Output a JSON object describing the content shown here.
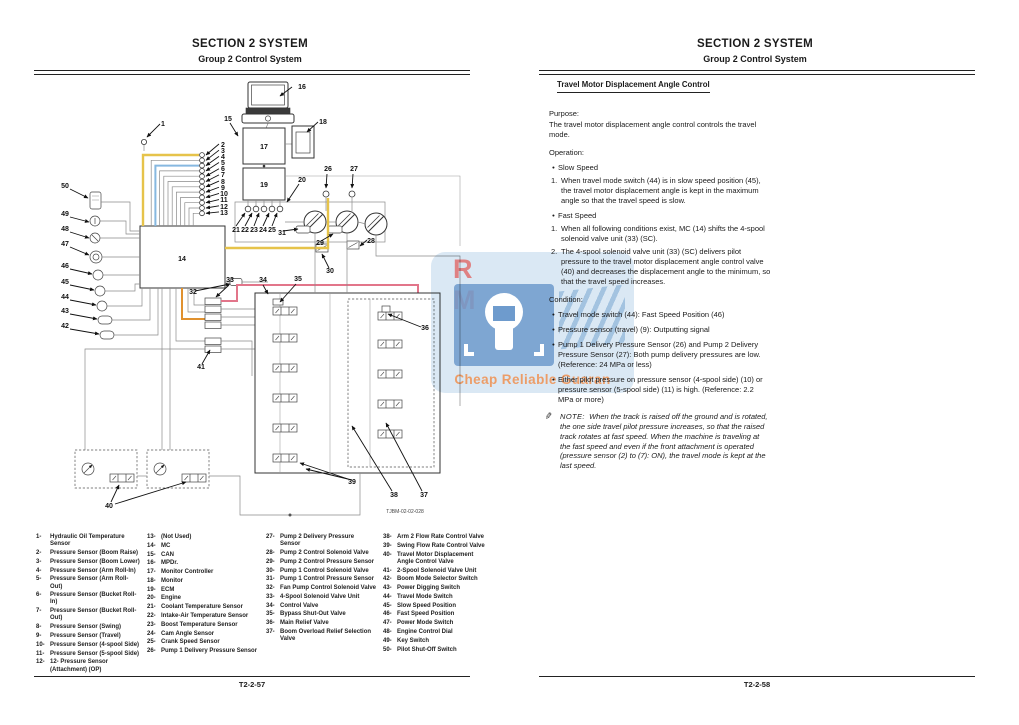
{
  "header": {
    "line1": "SECTION 2 SYSTEM",
    "line2": "Group 2 Control System"
  },
  "footer": {
    "left_page_number": "T2-2-57",
    "right_page_number": "T2-2-58"
  },
  "colors": {
    "can_line": "#e6c34a",
    "signal_line_blue": "#86b8e0",
    "pilot_line_pink": "#e2758a",
    "power_line_orange": "#e0912f",
    "watermark_blue": "#6e9bcd",
    "watermark_text_orange": "#ee965a",
    "watermark_rm_red": "#e07070"
  },
  "watermark": {
    "rm": "R M",
    "caption": "Cheap Reliable Guaran"
  },
  "diagram": {
    "code": "TJBM-02-02-028",
    "labels": [
      {
        "t": "16",
        "x": 272,
        "y": 13
      },
      {
        "t": "1",
        "x": 133,
        "y": 50
      },
      {
        "t": "15",
        "x": 198,
        "y": 45
      },
      {
        "t": "18",
        "x": 293,
        "y": 48
      },
      {
        "t": "17",
        "x": 234,
        "y": 73
      },
      {
        "t": "19",
        "x": 234,
        "y": 111
      },
      {
        "t": "20",
        "x": 272,
        "y": 106
      },
      {
        "t": "26",
        "x": 298,
        "y": 95
      },
      {
        "t": "27",
        "x": 324,
        "y": 95
      },
      {
        "t": "2",
        "x": 193,
        "y": 71
      },
      {
        "t": "3",
        "x": 193,
        "y": 77
      },
      {
        "t": "4",
        "x": 193,
        "y": 83
      },
      {
        "t": "5",
        "x": 193,
        "y": 89
      },
      {
        "t": "6",
        "x": 193,
        "y": 95
      },
      {
        "t": "7",
        "x": 193,
        "y": 101
      },
      {
        "t": "8",
        "x": 193,
        "y": 108
      },
      {
        "t": "9",
        "x": 193,
        "y": 114
      },
      {
        "t": "10",
        "x": 194,
        "y": 120
      },
      {
        "t": "11",
        "x": 194,
        "y": 126
      },
      {
        "t": "12",
        "x": 194,
        "y": 133
      },
      {
        "t": "13",
        "x": 194,
        "y": 139
      },
      {
        "t": "21",
        "x": 206,
        "y": 156
      },
      {
        "t": "22",
        "x": 215,
        "y": 156
      },
      {
        "t": "23",
        "x": 224,
        "y": 156
      },
      {
        "t": "24",
        "x": 233,
        "y": 156
      },
      {
        "t": "25",
        "x": 242,
        "y": 156
      },
      {
        "t": "31",
        "x": 252,
        "y": 159
      },
      {
        "t": "29",
        "x": 290,
        "y": 169
      },
      {
        "t": "30",
        "x": 300,
        "y": 197
      },
      {
        "t": "28",
        "x": 341,
        "y": 167
      },
      {
        "t": "14",
        "x": 152,
        "y": 185
      },
      {
        "t": "50",
        "x": 35,
        "y": 112
      },
      {
        "t": "49",
        "x": 35,
        "y": 140
      },
      {
        "t": "48",
        "x": 35,
        "y": 155
      },
      {
        "t": "47",
        "x": 35,
        "y": 170
      },
      {
        "t": "46",
        "x": 35,
        "y": 192
      },
      {
        "t": "45",
        "x": 35,
        "y": 208
      },
      {
        "t": "44",
        "x": 35,
        "y": 223
      },
      {
        "t": "43",
        "x": 35,
        "y": 237
      },
      {
        "t": "42",
        "x": 35,
        "y": 252
      },
      {
        "t": "32",
        "x": 163,
        "y": 218
      },
      {
        "t": "33",
        "x": 200,
        "y": 206
      },
      {
        "t": "41",
        "x": 171,
        "y": 293
      },
      {
        "t": "34",
        "x": 233,
        "y": 206
      },
      {
        "t": "35",
        "x": 268,
        "y": 205
      },
      {
        "t": "36",
        "x": 395,
        "y": 254
      },
      {
        "t": "39",
        "x": 322,
        "y": 408
      },
      {
        "t": "38",
        "x": 364,
        "y": 421
      },
      {
        "t": "37",
        "x": 394,
        "y": 421
      },
      {
        "t": "40",
        "x": 79,
        "y": 432
      }
    ]
  },
  "legend": {
    "columns": [
      [
        {
          "n": "1-",
          "t": "Hydraulic Oil Temperature Sensor"
        },
        {
          "n": "2-",
          "t": "Pressure Sensor (Boom Raise)"
        },
        {
          "n": "3-",
          "t": "Pressure Sensor (Boom Lower)"
        },
        {
          "n": "4-",
          "t": "Pressure Sensor (Arm Roll-In)"
        },
        {
          "n": "5-",
          "t": "Pressure Sensor (Arm Roll-Out)"
        },
        {
          "n": "6-",
          "t": "Pressure Sensor (Bucket Roll-In)"
        },
        {
          "n": "7-",
          "t": "Pressure Sensor (Bucket Roll-Out)"
        },
        {
          "n": "8-",
          "t": "Pressure Sensor (Swing)"
        },
        {
          "n": "9-",
          "t": "Pressure Sensor (Travel)"
        },
        {
          "n": "10-",
          "t": "Pressure Sensor (4-spool Side)"
        },
        {
          "n": "11-",
          "t": "Pressure Sensor (5-spool Side)"
        },
        {
          "n": "12-",
          "t": "12-  Pressure Sensor (Attachment) (OP)"
        }
      ],
      [
        {
          "n": "13-",
          "t": "(Not Used)"
        },
        {
          "n": "14-",
          "t": "MC"
        },
        {
          "n": "15-",
          "t": "CAN"
        },
        {
          "n": "16-",
          "t": "MPDr."
        },
        {
          "n": "17-",
          "t": "Monitor Controller"
        },
        {
          "n": "18-",
          "t": "Monitor"
        },
        {
          "n": "19-",
          "t": "ECM"
        },
        {
          "n": "20-",
          "t": "Engine"
        },
        {
          "n": "21-",
          "t": "Coolant Temperature Sensor"
        },
        {
          "n": "22-",
          "t": "Intake-Air Temperature Sensor"
        },
        {
          "n": "23-",
          "t": "Boost Temperature Sensor"
        },
        {
          "n": "24-",
          "t": "Cam Angle Sensor"
        },
        {
          "n": "25-",
          "t": "Crank Speed Sensor"
        },
        {
          "n": "26-",
          "t": "Pump 1 Delivery Pressure Sensor"
        }
      ],
      [
        {
          "n": "27-",
          "t": "Pump 2 Delivery Pressure Sensor"
        },
        {
          "n": "28-",
          "t": "Pump 2 Control Solenoid Valve"
        },
        {
          "n": "29-",
          "t": "Pump 2 Control Pressure Sensor"
        },
        {
          "n": "30-",
          "t": "Pump 1 Control Solenoid Valve"
        },
        {
          "n": "31-",
          "t": "Pump 1 Control Pressure Sensor"
        },
        {
          "n": "32-",
          "t": "Fan Pump Control Solenoid Valve"
        },
        {
          "n": "33-",
          "t": "4-Spool Solenoid Valve Unit"
        },
        {
          "n": "34-",
          "t": "Control Valve"
        },
        {
          "n": "35-",
          "t": "Bypass Shut-Out Valve"
        },
        {
          "n": "36-",
          "t": "Main Relief Valve"
        },
        {
          "n": "37-",
          "t": "Boom Overload Relief Selection Valve"
        }
      ],
      [
        {
          "n": "38-",
          "t": "Arm 2 Flow Rate Control Valve"
        },
        {
          "n": "39-",
          "t": "Swing Flow Rate Control Valve"
        },
        {
          "n": "40-",
          "t": "Travel Motor Displacement Angle Control Valve"
        },
        {
          "n": "41-",
          "t": "2-Spool Solenoid Valve Unit"
        },
        {
          "n": "42-",
          "t": "Boom Mode Selector Switch"
        },
        {
          "n": "43-",
          "t": "Power Digging Switch"
        },
        {
          "n": "44-",
          "t": "Travel Mode Switch"
        },
        {
          "n": "45-",
          "t": "Slow Speed Position"
        },
        {
          "n": "46-",
          "t": "Fast Speed Position"
        },
        {
          "n": "47-",
          "t": "Power Mode Switch"
        },
        {
          "n": "48-",
          "t": "Engine Control Dial"
        },
        {
          "n": "49-",
          "t": "Key Switch"
        },
        {
          "n": "50-",
          "t": "Pilot Shut-Off Switch"
        }
      ]
    ]
  },
  "right_page": {
    "sections": [
      {
        "type": "heading",
        "text": "Travel Motor Displacement Angle Control"
      },
      {
        "type": "label",
        "text": "Purpose:"
      },
      {
        "type": "para",
        "text": "The travel motor displacement angle control controls the travel mode."
      },
      {
        "type": "label",
        "text": "Operation:"
      },
      {
        "type": "bullet",
        "text": "Slow Speed"
      },
      {
        "type": "num",
        "n": "1.",
        "text": "When travel mode switch (44) is in slow speed position (45), the travel motor displacement angle is kept in the maximum angle so that the travel speed is slow."
      },
      {
        "type": "bullet",
        "text": "Fast Speed"
      },
      {
        "type": "num",
        "n": "1.",
        "text": "When all following conditions exist, MC (14) shifts the 4-spool solenoid valve unit (33) (SC)."
      },
      {
        "type": "num",
        "n": "2.",
        "text": "The 4-spool solenoid valve unit (33) (SC) delivers pilot pressure to the travel motor displacement angle control valve (40) and decreases the displacement angle to the minimum, so that the travel speed increases."
      },
      {
        "type": "label",
        "text": "Condition:"
      },
      {
        "type": "bullet",
        "text": "Travel mode switch (44): Fast Speed Position (46)"
      },
      {
        "type": "bullet",
        "text": "Pressure sensor (travel) (9): Outputting signal"
      },
      {
        "type": "bullet",
        "text": "Pump 1 Delivery Pressure Sensor (26) and Pump 2 Delivery Pressure Sensor (27): Both pump delivery pressures are low. (Reference: 24 MPa or less)"
      },
      {
        "type": "bullet",
        "text": "Either pilot pressure on pressure sensor (4-spool side) (10) or pressure sensor (5-spool side) (11) is high. (Reference: 2.2 MPa or more)"
      },
      {
        "type": "note",
        "label": "NOTE:",
        "text": "When the track is raised off the ground and is rotated, the one side travel pilot pressure increases, so that the raised track rotates at fast speed. When the machine is traveling at the fast speed and even if the front attachment is operated (pressure sensor (2) to (7): ON), the travel mode is kept at the last speed."
      }
    ]
  }
}
